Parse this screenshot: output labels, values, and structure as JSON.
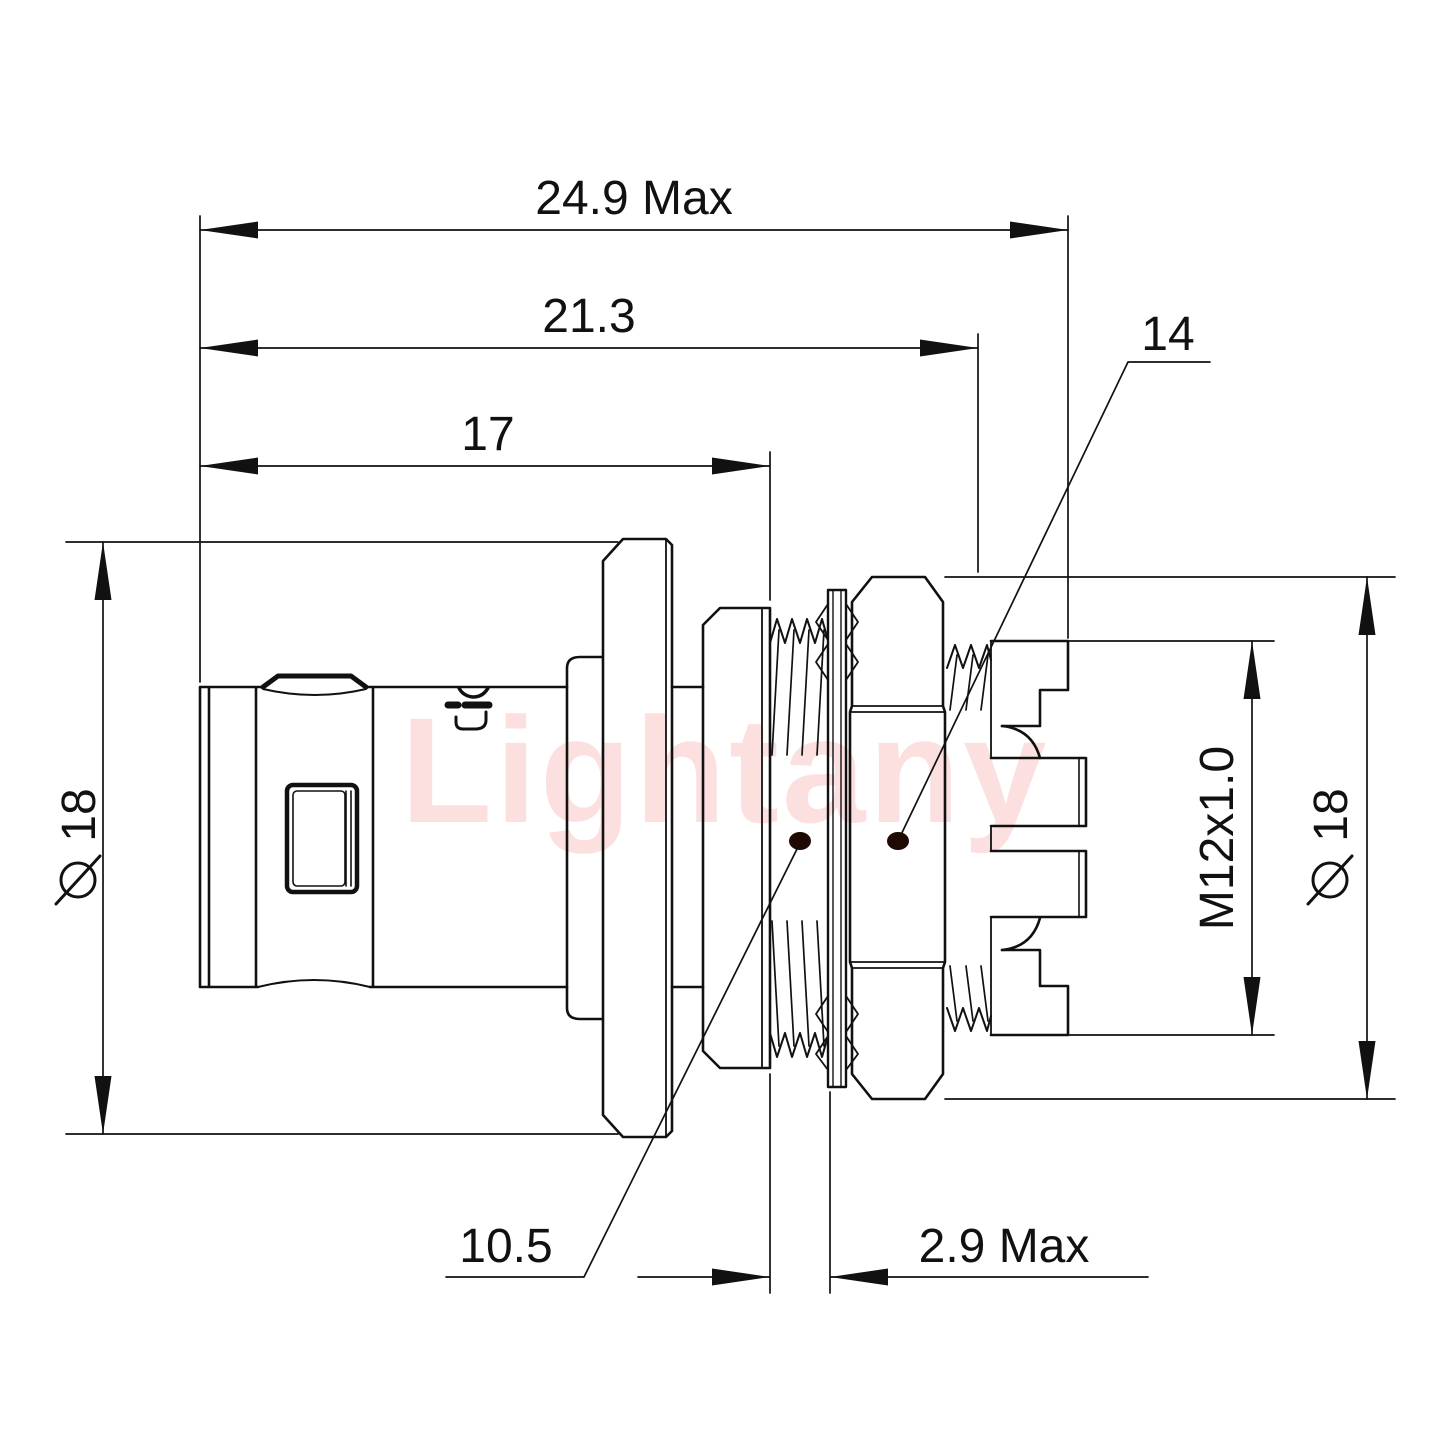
{
  "watermark": {
    "text": "Lightany",
    "color": "#ee3a34"
  },
  "body_logo": {
    "text": "Lightany"
  },
  "style": {
    "line_color": "#111111",
    "background": "#ffffff",
    "leader_dot_color": "#1e0903",
    "watermark_color": "#ee3a34"
  },
  "dimensions": {
    "overall_length": {
      "label": "24.9 Max"
    },
    "length_to_panel": {
      "label": "21.3"
    },
    "front_length": {
      "label": "17"
    },
    "nut_leader": {
      "label": "14"
    },
    "plug_diameter": {
      "symbol": "⌀",
      "value": "18"
    },
    "rear_diameter": {
      "symbol": "⌀",
      "value": "18"
    },
    "thread_spec": {
      "label": "M12x1.0"
    },
    "shank_leader": {
      "label": "10.5"
    },
    "panel_thickness": {
      "label": "2.9 Max"
    }
  }
}
